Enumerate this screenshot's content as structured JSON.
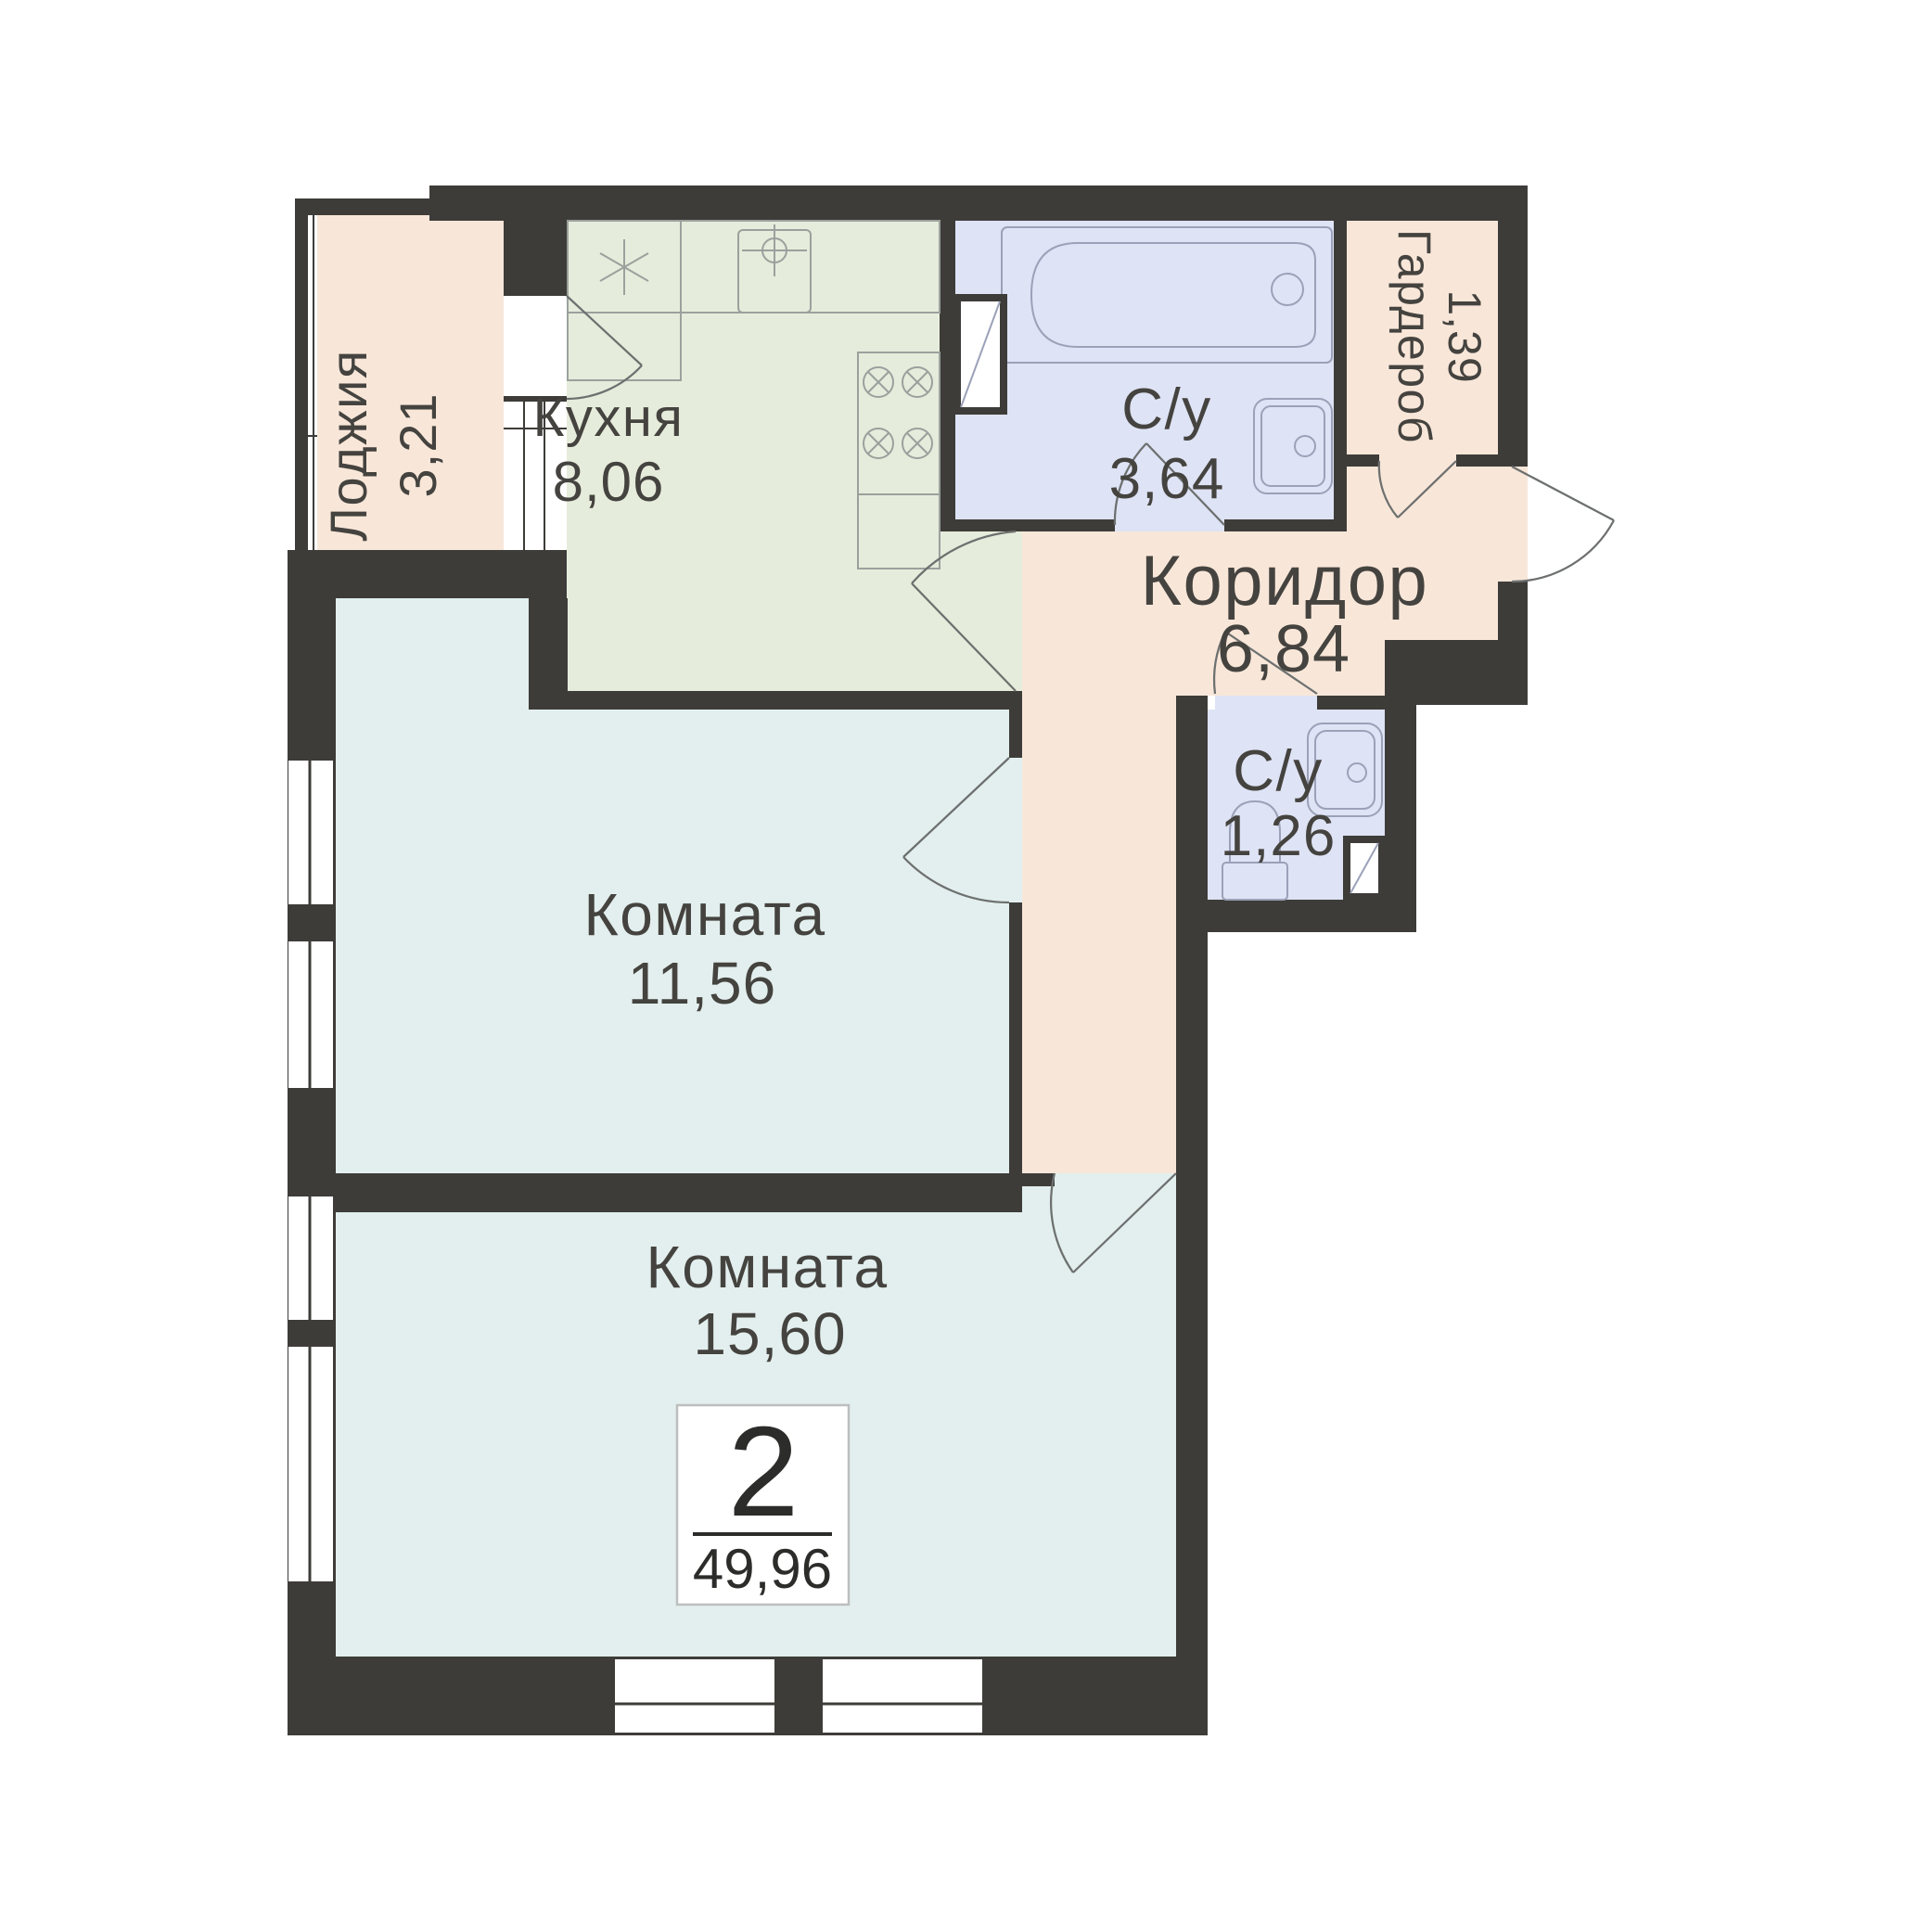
{
  "plan": {
    "title": "Floor plan of 2-room apartment",
    "badge": {
      "rooms_count": "2",
      "total_area": "49,96"
    },
    "rooms": [
      {
        "id": "loggia",
        "label": "Лоджия",
        "area": "3,21"
      },
      {
        "id": "kitchen",
        "label": "Кухня",
        "area": "8,06"
      },
      {
        "id": "bathroom",
        "label": "С/у",
        "area": "3,64"
      },
      {
        "id": "wardrobe",
        "label": "Гардероб",
        "area": "1,39"
      },
      {
        "id": "corridor",
        "label": "Коридор",
        "area": "6,84"
      },
      {
        "id": "wc",
        "label": "С/у",
        "area": "1,26"
      },
      {
        "id": "room-1",
        "label": "Комната",
        "area": "11,56"
      },
      {
        "id": "room-2",
        "label": "Комната",
        "area": "15,60"
      }
    ],
    "colors": {
      "wall": "#3e3c39",
      "loggia": "#f8e7d9",
      "kitchen": "#e6ecdb",
      "bathroom": "#dee3f5",
      "wardrobe": "#f8e7d9",
      "corridor": "#f8e7d9",
      "wc": "#dee3f5",
      "room1": "#e2efee",
      "room2": "#e2efee",
      "white": "#ffffff"
    }
  }
}
